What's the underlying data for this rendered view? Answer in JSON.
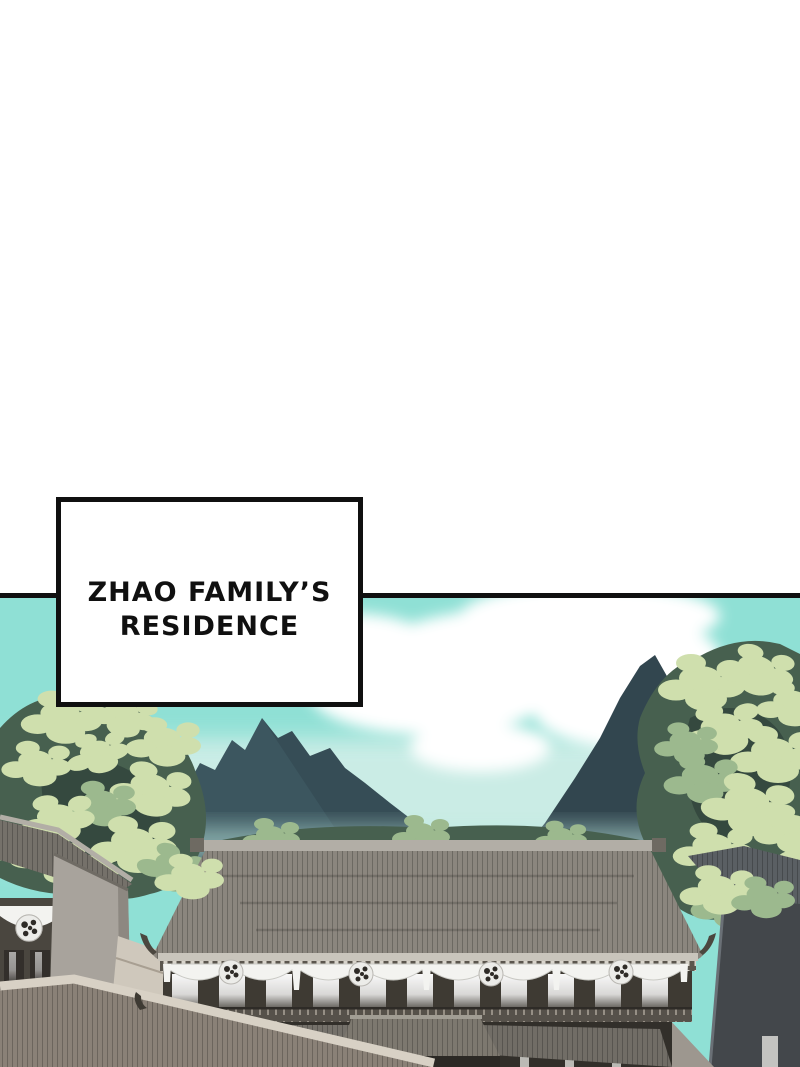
{
  "caption": {
    "line1": "ZHAO FAMILY’S",
    "line2": "RESIDENCE"
  },
  "palette": {
    "page_bg": "#ffffff",
    "ink": "#101010",
    "sky": "#8fe0d5",
    "sky_pale": "#d9f0ea",
    "cloud": "#ffffff",
    "mountain_far": "#54707a",
    "mountain_mid": "#3c565f",
    "mountain_near": "#32464f",
    "mist": "#bde9e0",
    "leaf_light": "#cfdfad",
    "leaf_mid": "#9cb98e",
    "leaf_dark": "#47604f",
    "leaf_deep": "#35493f",
    "roof": "#8b867e",
    "roof_dark": "#75716a",
    "ridge": "#b2aea6",
    "fascia": "#c9c5bc",
    "bracket_band": "#5b564e",
    "timber": "#3e3a33",
    "drape": "#f3f3f0",
    "glow": "#ffffff",
    "wall_light": "#a8a39c",
    "wall_dark": "#43474b",
    "walkway": "#cfc8bc",
    "ground_roof": "#8a8177",
    "ground_dark": "#322f2a"
  }
}
